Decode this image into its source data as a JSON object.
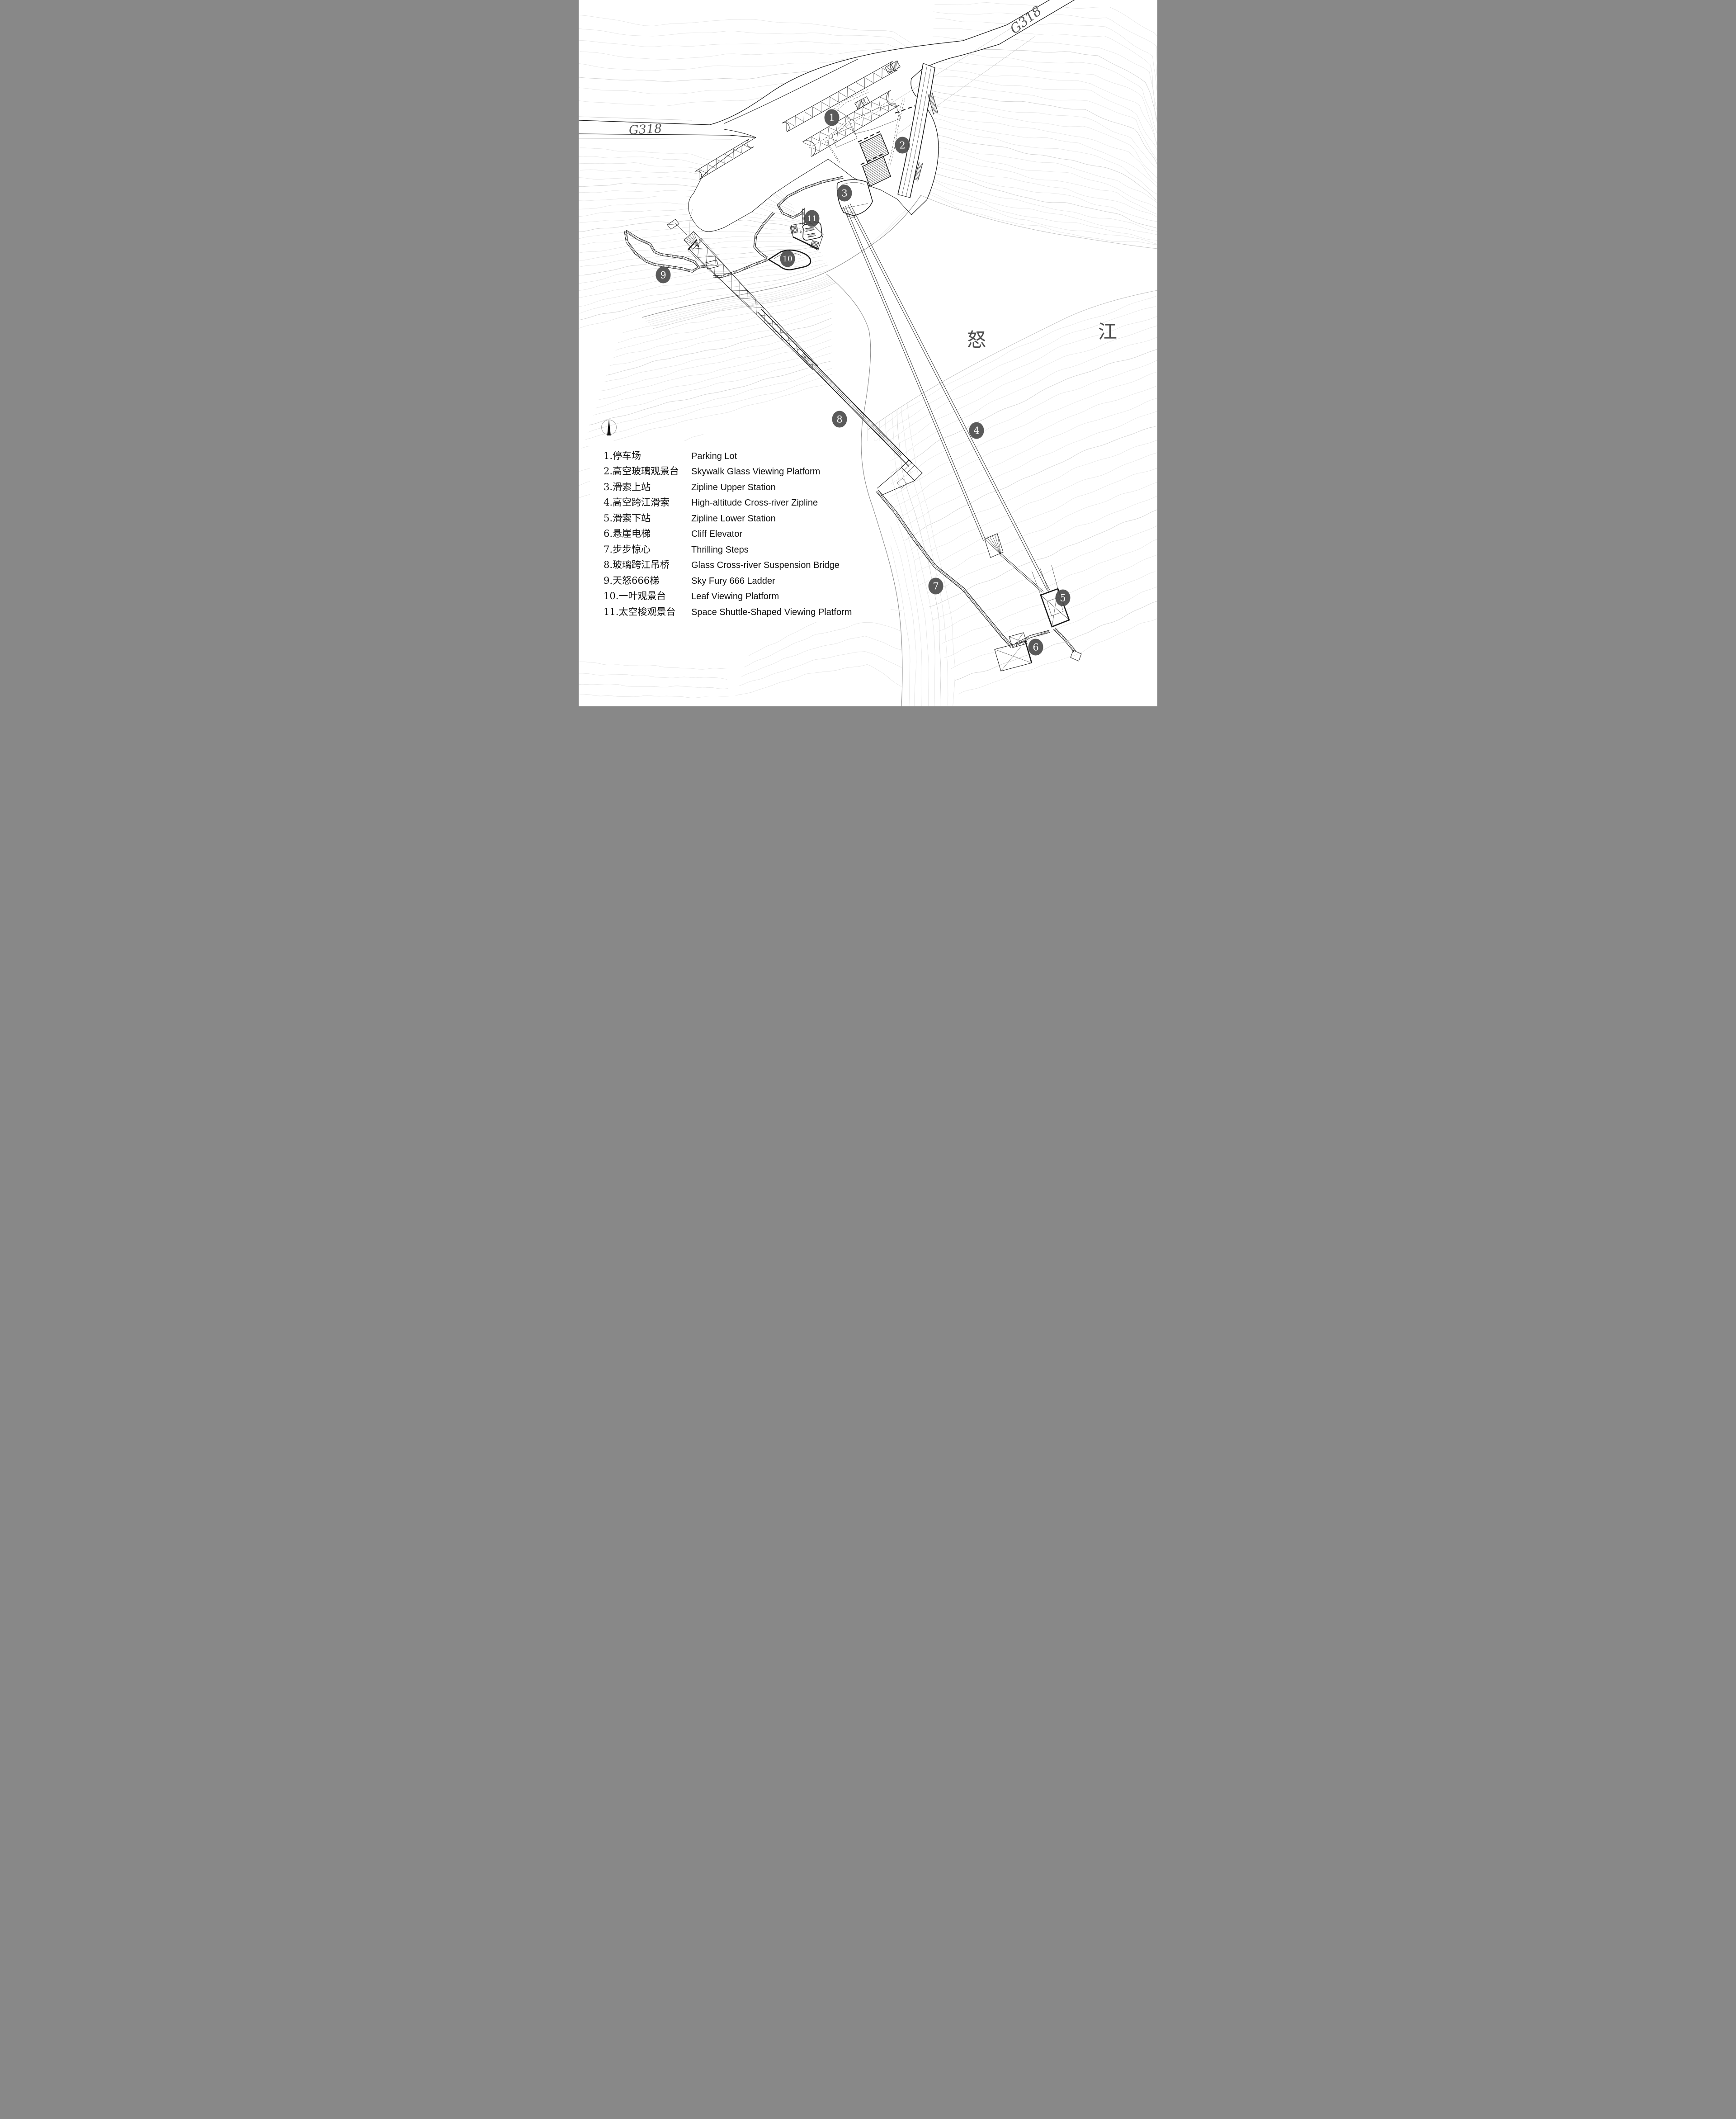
{
  "plan": {
    "road_labels": [
      {
        "id": "g318-west",
        "text": "G318"
      },
      {
        "id": "g318-northeast",
        "text": "G318"
      }
    ],
    "river_label": {
      "char_1": "怒",
      "char_2": "江",
      "full": "怒江"
    },
    "stair_note": "k",
    "markers": [
      {
        "label": "1"
      },
      {
        "label": "2"
      },
      {
        "label": "3"
      },
      {
        "label": "4"
      },
      {
        "label": "5"
      },
      {
        "label": "6"
      },
      {
        "label": "7"
      },
      {
        "label": "8"
      },
      {
        "label": "9"
      },
      {
        "label": "10"
      },
      {
        "label": "11"
      }
    ]
  },
  "legend": {
    "items": [
      {
        "zh": "1.停车场",
        "en": "Parking Lot"
      },
      {
        "zh": "2.高空玻璃观景台",
        "en": "Skywalk Glass Viewing Platform"
      },
      {
        "zh": "3.滑索上站",
        "en": "Zipline Upper Station"
      },
      {
        "zh": "4.高空跨江滑索",
        "en": "High-altitude Cross-river Zipline"
      },
      {
        "zh": "5.滑索下站",
        "en": "Zipline Lower Station"
      },
      {
        "zh": "6.悬崖电梯",
        "en": "Cliff Elevator"
      },
      {
        "zh": "7.步步惊心",
        "en": "Thrilling Steps"
      },
      {
        "zh": "8.玻璃跨江吊桥",
        "en": "Glass Cross-river Suspension Bridge"
      },
      {
        "zh": "9.天怒666梯",
        "en": "Sky Fury 666 Ladder"
      },
      {
        "zh": "10.一叶观景台",
        "en": "Leaf Viewing Platform"
      },
      {
        "zh": "11.太空梭观景台",
        "en": "Space Shuttle-Shaped Viewing Platform"
      }
    ]
  }
}
